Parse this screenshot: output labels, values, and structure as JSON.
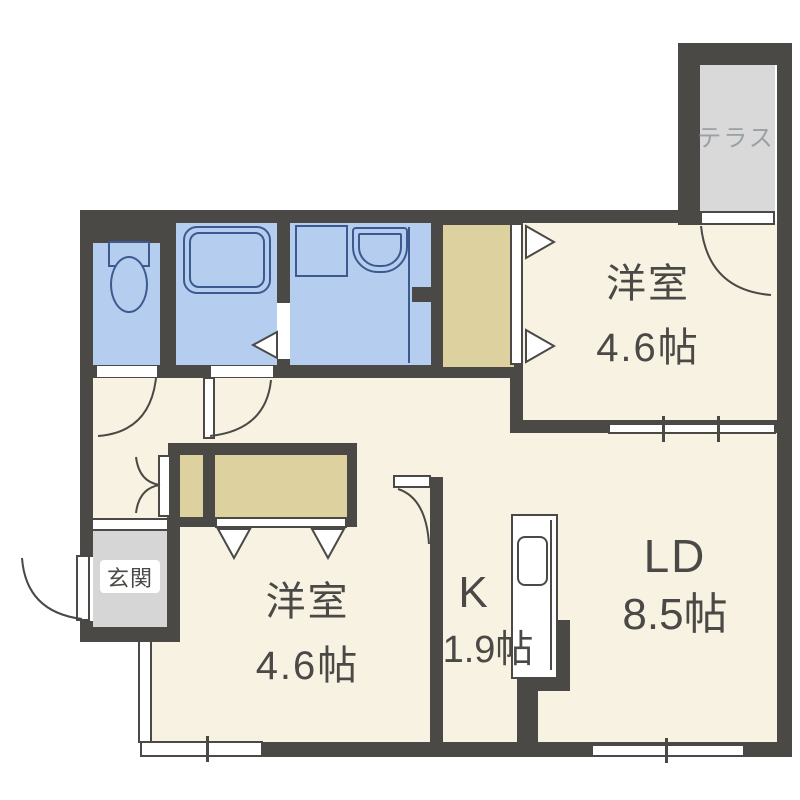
{
  "plan_title": "1LDK apartment floor plan",
  "palette": {
    "wall": "#4a4946",
    "floor": "#f8f2e2",
    "wet": "#b5cdef",
    "fixture": "#3c5a8e",
    "closet": "#ddd1a0",
    "genkan": "#d6d6d6",
    "terrace": "#d9d9d9",
    "text": "#4a4946",
    "terrace_text": "#9aa0a4"
  },
  "rooms": {
    "terrace": {
      "label": "テラス"
    },
    "bedroom_top": {
      "label": "洋室",
      "size": "4.6帖"
    },
    "bedroom_bottom": {
      "label": "洋室",
      "size": "4.6帖"
    },
    "kitchen": {
      "label": "K",
      "size": "1.9帖"
    },
    "living_dining": {
      "label": "LD",
      "size": "8.5帖"
    },
    "entrance": {
      "label": "玄関"
    }
  }
}
